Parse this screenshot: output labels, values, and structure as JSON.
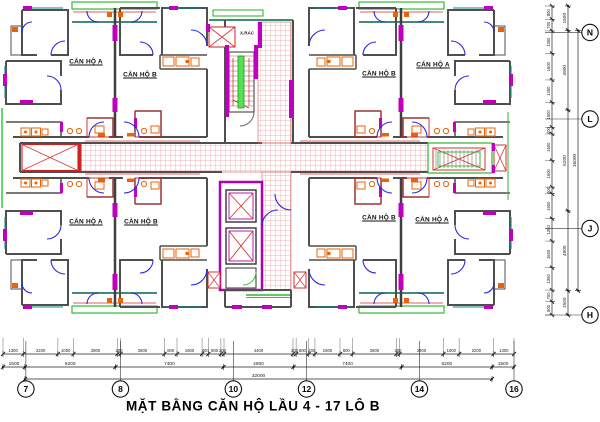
{
  "title": "MẶT BẰNG CĂN HỘ LẦU 4 - 17 LÔ B",
  "plan": {
    "apartment_labels": [
      {
        "id": "top-left-a",
        "text": "CĂN HỘ A"
      },
      {
        "id": "top-left-b",
        "text": "CĂN HỘ B"
      },
      {
        "id": "top-right-b",
        "text": "CĂN HỘ B"
      },
      {
        "id": "top-right-a",
        "text": "CĂN HỘ A"
      },
      {
        "id": "bottom-left-a",
        "text": "CĂN HỘ A"
      },
      {
        "id": "bottom-left-b",
        "text": "CĂN HỘ B"
      },
      {
        "id": "bottom-right-b",
        "text": "CĂN HỘ B"
      },
      {
        "id": "bottom-right-a",
        "text": "CĂN HỘ A"
      }
    ],
    "room_labels": [
      {
        "id": "trash-chute",
        "text": "X.RÁC"
      }
    ]
  },
  "grid": {
    "bottom_bubbles": [
      "7",
      "8",
      "10",
      "12",
      "14",
      "16"
    ],
    "right_bubbles": [
      "N",
      "L",
      "J",
      "H"
    ]
  },
  "dimensions": {
    "bottom_detail": [
      1300,
      2200,
      1000,
      2800,
      200,
      2800,
      800,
      1600,
      400,
      800,
      200,
      4400,
      200,
      800,
      400,
      1600,
      800,
      2800,
      200,
      2800,
      1000,
      2200,
      1300
    ],
    "bottom_intermediate": [
      1500,
      6200,
      7400,
      4800,
      7400,
      6200,
      1500
    ],
    "bottom_overall": [
      32000
    ],
    "right_detail": [
      800,
      700,
      1350,
      1600,
      1350,
      1500,
      400,
      1600,
      1600,
      400,
      1500,
      1350,
      1600,
      1350,
      700,
      800
    ],
    "right_intermediate": [
      1500,
      4900,
      6200,
      4900,
      1500
    ],
    "right_overall": [
      16000
    ]
  },
  "colors": {
    "wall": "#4f4f4f",
    "door": "#2a2ae0",
    "column_magenta": "#bf00bf",
    "fixture_orange": "#e8640a",
    "hatch_red": "#f09a9a",
    "accent_red": "#cc2222",
    "accent_green": "#2db82d",
    "stair_rail_green": "#55e055",
    "window_teal": "#0a8a8a",
    "dimension_text": "#1a1a1a"
  }
}
